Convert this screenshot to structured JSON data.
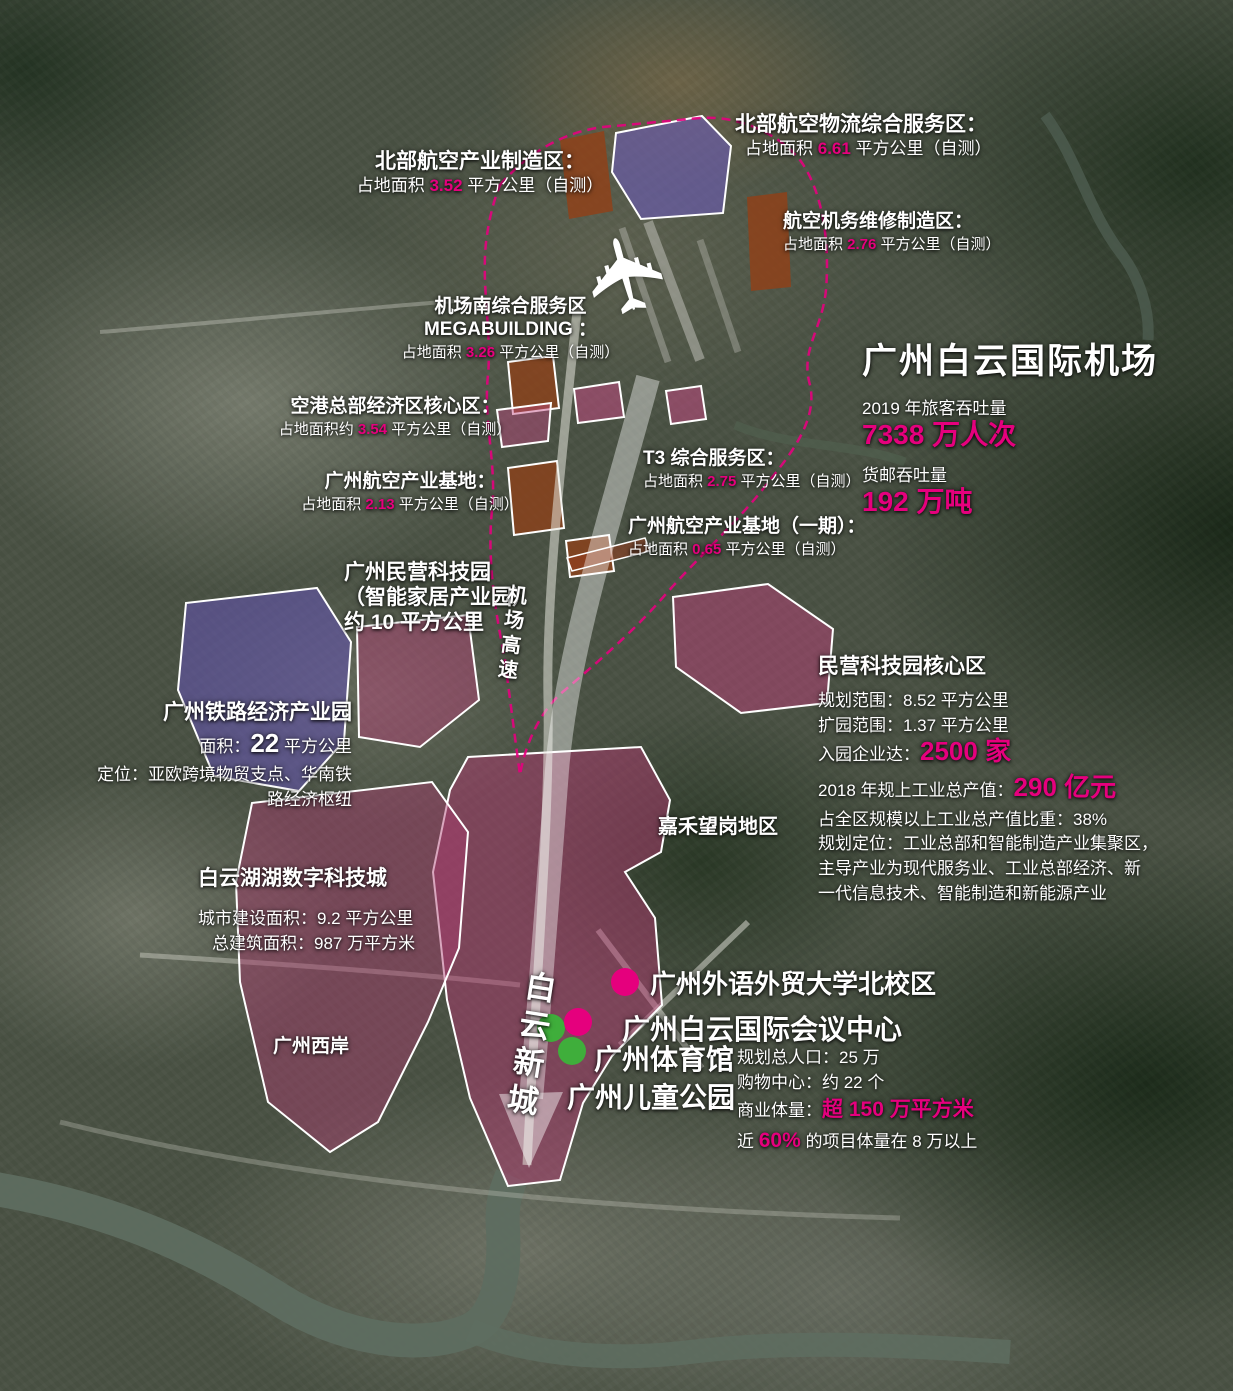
{
  "palette": {
    "magenta": "#e5007d",
    "green_dot": "#3fae3b",
    "zone_purple": "#6b55b0",
    "zone_pink": "#c04880",
    "zone_brown": "#92400f",
    "boundary_pink": "#e6007e"
  },
  "airport": {
    "title": "广州白云国际机场",
    "passenger_label": "2019 年旅客吞吐量",
    "passenger_value": "7338 万人次",
    "cargo_label": "货邮吞吐量",
    "cargo_value": "192 万吨"
  },
  "zone_labels": [
    {
      "title": "北部航空物流综合服务区：",
      "pre": "占地面积 ",
      "value": "6.61",
      "post": " 平方公里（自测）"
    },
    {
      "title": "北部航空产业制造区：",
      "pre": "占地面积 ",
      "value": "3.52",
      "post": " 平方公里（自测）"
    },
    {
      "title": "航空机务维修制造区：",
      "pre": "占地面积 ",
      "value": "2.76",
      "post": " 平方公里（自测）"
    },
    {
      "title": "机场南综合服务区",
      "title2": "MEGABUILDING ：",
      "pre": "占地面积 ",
      "value": "3.26",
      "post": " 平方公里（自测）"
    },
    {
      "title": "空港总部经济区核心区：",
      "pre": "占地面积约 ",
      "value": "3.54",
      "post": " 平方公里（自测）"
    },
    {
      "title": "广州航空产业基地：",
      "pre": "占地面积 ",
      "value": "2.13",
      "post": " 平方公里（自测）"
    },
    {
      "title": "T3 综合服务区：",
      "pre": "占地面积 ",
      "value": "2.75",
      "post": " 平方公里（自测）"
    },
    {
      "title": "广州航空产业基地（一期）：",
      "pre": "占地面积 ",
      "value": "0.65",
      "post": " 平方公里（自测）"
    }
  ],
  "tech_park": {
    "line1": "广州民营科技园",
    "line2": "（智能家居产业园）",
    "line3": "约 10 平方公里"
  },
  "core_zone": {
    "title": "民营科技园核心区",
    "scope1": "规划范围：8.52 平方公里",
    "scope2": "扩园范围：1.37 平方公里",
    "enterprises_pre": "入园企业达：",
    "enterprises_value": "2500 家",
    "output_pre": "2018 年规上工业总产值：",
    "output_value": "290 亿元",
    "share": "占全区规模以上工业总产值比重：38%",
    "position1": "规划定位：工业总部和智能制造产业集聚区，",
    "position2": "主导产业为现代服务业、工业总部经济、新",
    "position3": "一代信息技术、智能制造和新能源产业"
  },
  "railway_park": {
    "title": "广州铁路经济产业园",
    "area_pre": "面积：",
    "area_value": "22",
    "area_post": " 平方公里",
    "position1": "定位：亚欧跨境物贸支点、华南铁",
    "position2": "路经济枢纽"
  },
  "baiyun_lake": {
    "title": "白云湖湖数字科技城",
    "line1": "城市建设面积：9.2 平方公里",
    "line2": "总建筑面积：987 万平方米"
  },
  "area_names": {
    "jiahe": "嘉禾望岗地区",
    "west_bank": "广州西岸",
    "highway": "机场高速",
    "new_town": "白云新城"
  },
  "poi": [
    {
      "name": "广州外语外贸大学北校区"
    },
    {
      "name": "广州白云国际会议中心"
    },
    {
      "name": "广州体育馆"
    },
    {
      "name": "广州儿童公园"
    }
  ],
  "new_town_stats": {
    "line1": "规划总人口：25 万",
    "line2": "购物中心：约 22 个",
    "line3_pre": "商业体量：",
    "line3_value": "超 150 万平方米",
    "line4_pre": "近 ",
    "line4_value": "60%",
    "line4_post": " 的项目体量在 8 万以上"
  }
}
